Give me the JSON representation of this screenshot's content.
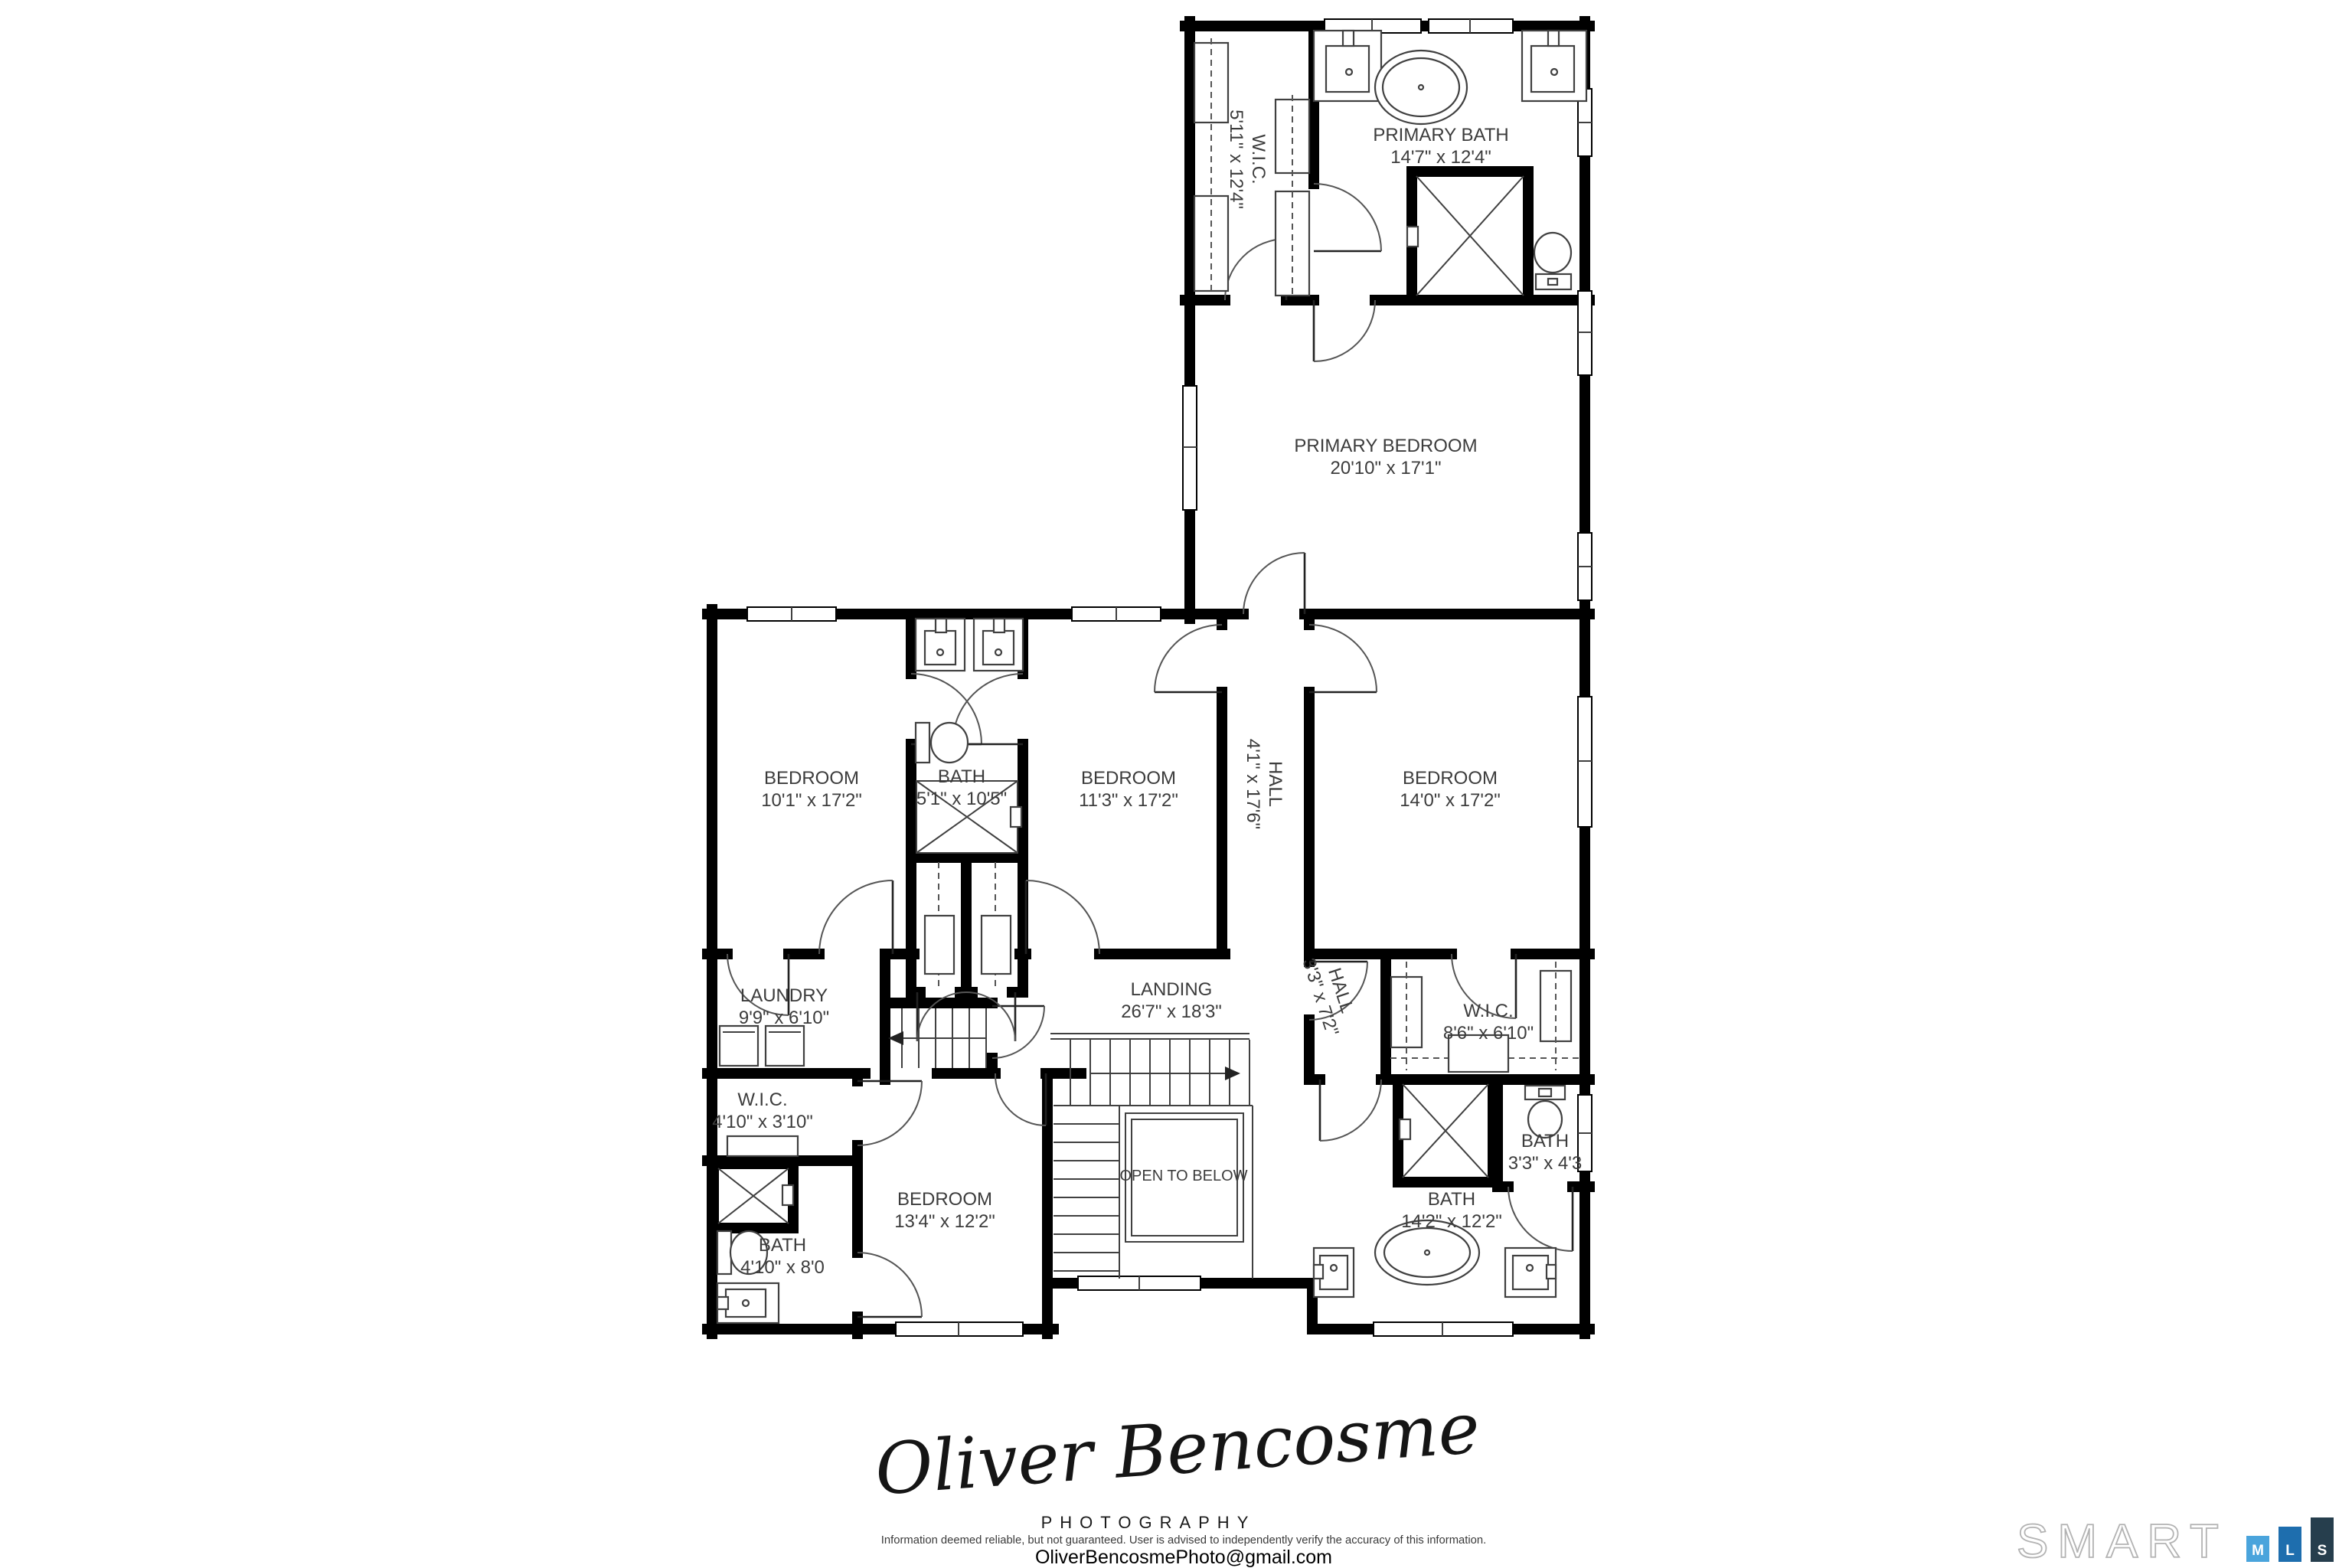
{
  "plan": {
    "rooms": {
      "wic_top": {
        "name": "W.I.C.",
        "dims": "5'11\" x 12'4\""
      },
      "primary_bath": {
        "name": "PRIMARY BATH",
        "dims": "14'7\" x 12'4\""
      },
      "primary_bedroom": {
        "name": "PRIMARY BEDROOM",
        "dims": "20'10\" x 17'1\""
      },
      "bedroom_left": {
        "name": "BEDROOM",
        "dims": "10'1\" x 17'2\""
      },
      "bath_center": {
        "name": "BATH",
        "dims": "5'1\" x 10'5\""
      },
      "bedroom_mid": {
        "name": "BEDROOM",
        "dims": "11'3\" x 17'2\""
      },
      "hall": {
        "name": "HALL",
        "dims": "4'1\" x 17'6\""
      },
      "bedroom_right": {
        "name": "BEDROOM",
        "dims": "14'0\" x 17'2\""
      },
      "laundry": {
        "name": "LAUNDRY",
        "dims": "9'9\" x 6'10\""
      },
      "landing": {
        "name": "LANDING",
        "dims": "26'7\" x 18'3\""
      },
      "hall_small": {
        "name": "HALL",
        "dims": "3'3\" x 7'2\""
      },
      "wic_right": {
        "name": "W.I.C.",
        "dims": "8'6\" x 6'10\""
      },
      "wic_small": {
        "name": "W.I.C.",
        "dims": "4'10\" x 3'10\""
      },
      "bedroom_bottom": {
        "name": "BEDROOM",
        "dims": "13'4\" x 12'2\""
      },
      "open_to_below": {
        "name": "OPEN TO BELOW"
      },
      "bath_small": {
        "name": "BATH",
        "dims": "3'3\" x 4'3"
      },
      "bath_bottom": {
        "name": "BATH",
        "dims": "14'2\" x 12'2\""
      },
      "bath_left": {
        "name": "BATH",
        "dims": "4'10\" x 8'0"
      }
    }
  },
  "branding": {
    "signature": "Oliver Bencosme",
    "subtitle": "PHOTOGRAPHY",
    "disclaimer": "Information deemed reliable, but not guaranteed. User is advised to independently verify the accuracy of this information.",
    "email": "OliverBencosmePhoto@gmail.com"
  },
  "logo": {
    "wordmark": "SMART",
    "blocks": [
      {
        "letter": "M",
        "color": "#4AA4DC"
      },
      {
        "letter": "L",
        "color": "#1E6EAE"
      },
      {
        "letter": "S",
        "color": "#263E4D"
      }
    ]
  }
}
